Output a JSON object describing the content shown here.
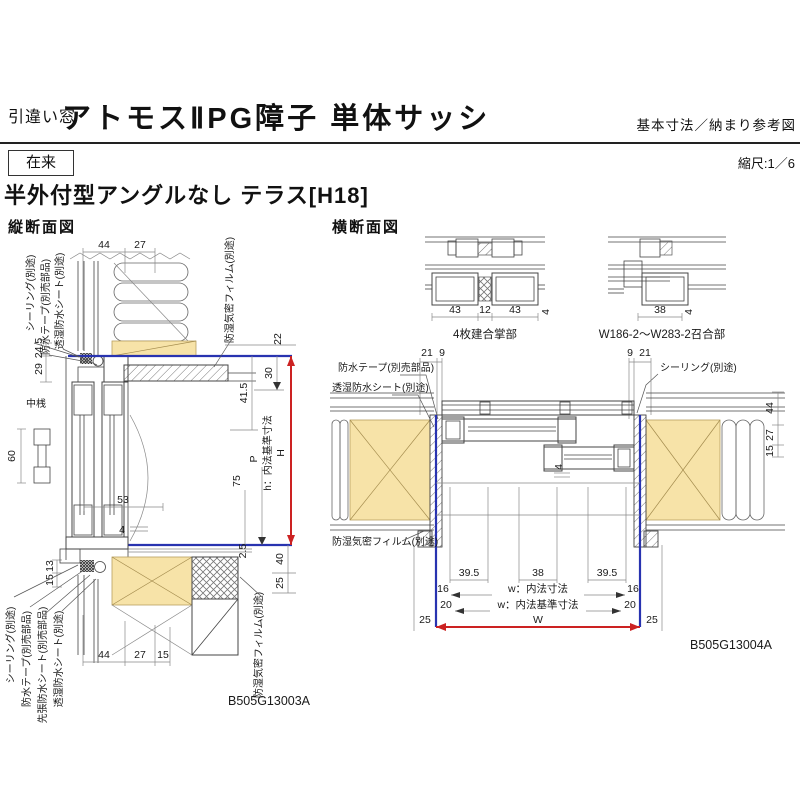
{
  "header": {
    "window_type": "引違い窓",
    "title": "アトモスⅡPG障子 単体サッシ",
    "subtitle": "基本寸法／納まり参考図",
    "construction_label": "在来",
    "scale_label": "縮尺:1／6",
    "section_title": "半外付型アングルなし テラス[H18]"
  },
  "vertical_section": {
    "title": "縦断面図",
    "drawing_id": "B505G13003A",
    "annotations": {
      "sealing_top": "シーリング(別途)",
      "tape_top": "防水テープ(別売部品)",
      "sheet_top": "透湿防水シート(別途)",
      "film_top": "防湿気密フィルム(別途)",
      "mullion": "中桟",
      "h_axis": "h：内法基準寸法",
      "H": "H",
      "P": "P",
      "sealing_bottom": "シーリング(別途)",
      "tape_bottom": "防水テープ(別売部品)",
      "presheet_bottom": "先張防水シート(別売部品)",
      "sheet_bottom": "透湿防水シート(別途)",
      "film_bottom": "防湿気密フィルム(別途)"
    },
    "dimensions": {
      "top_44": "44",
      "top_27": "27",
      "left_24_5": "24.5",
      "left_29": "29",
      "left_60": "60",
      "left_13": "13",
      "left_15": "15",
      "right_22": "22",
      "right_30": "30",
      "right_41_5": "41.5",
      "mid_53": "53",
      "mid_4": "4",
      "right_75": "75",
      "right_2_5": "2.5",
      "right_40": "40",
      "right_25": "25",
      "bottom_44": "44",
      "bottom_27": "27",
      "bottom_15": "15"
    }
  },
  "horizontal_section": {
    "title": "横断面図",
    "drawing_id": "B505G13004A",
    "detail_gassho": {
      "caption": "4枚建合掌部",
      "d43l": "43",
      "d12": "12",
      "d43r": "43",
      "d4": "4"
    },
    "detail_meeting": {
      "caption": "W186-2～W283-2召合部",
      "d38": "38",
      "d4": "4"
    },
    "annotations": {
      "tape": "防水テープ(別売部品)",
      "sheet": "透湿防水シート(別途)",
      "sealing": "シーリング(別途)",
      "film": "防湿気密フィルム(別途)",
      "w_inner": "w：内法寸法",
      "w_base": "w：内法基準寸法",
      "W": "W"
    },
    "dimensions": {
      "top_left_21": "21",
      "top_left_9": "9",
      "top_right_9": "9",
      "top_right_21": "21",
      "right_44": "44",
      "right_27": "27",
      "right_15": "15",
      "mid_4": "4",
      "b39_5_l": "39.5",
      "b38": "38",
      "b39_5_r": "39.5",
      "b16_l": "16",
      "b16_r": "16",
      "b20_l": "20",
      "b20_r": "20",
      "b25_l": "25",
      "b25_r": "25"
    }
  },
  "colors": {
    "accent_red": "#cc2222",
    "accent_blue": "#2833b0",
    "wood_fill": "#f7e3a8"
  }
}
